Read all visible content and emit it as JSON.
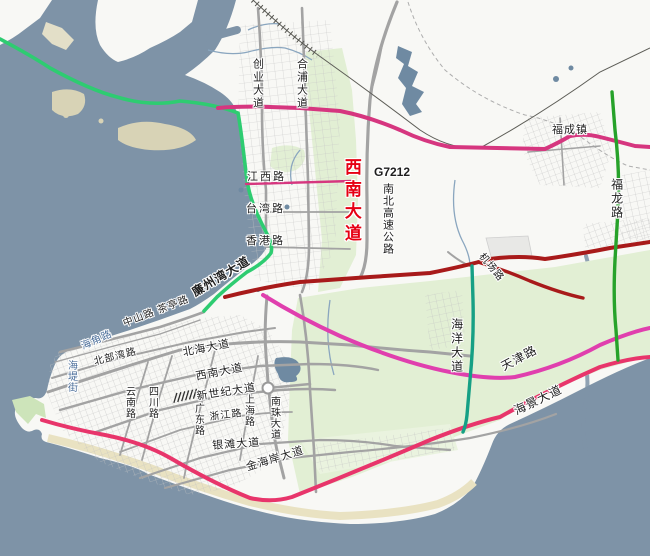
{
  "map": {
    "region": "coastal-city-planning-map",
    "colors": {
      "sea": "#7e93a7",
      "land": "#f8f8f5",
      "vegetation": "#e2efd4",
      "sand_flat": "#d8d3b6",
      "beach": "#e9e2c2",
      "road_gray": "#a3a3a3",
      "road_green": "#2ecc71",
      "road_dark_green": "#27a22a",
      "road_magenta": "#d6367f",
      "road_pink": "#e03fae",
      "road_crimson": "#e8356b",
      "road_dark_red": "#a81a1a",
      "road_teal": "#16a085",
      "label_red": "#e60013",
      "label_blue": "#4c6f9b"
    }
  },
  "labels": [
    {
      "id": "chuangye-dadao",
      "text": "创业大道"
    },
    {
      "id": "hepu-dadao",
      "text": "合浦大道"
    },
    {
      "id": "jiangxi-lu",
      "text": "江西路"
    },
    {
      "id": "taiwan-lu",
      "text": "台湾路"
    },
    {
      "id": "xianggang-lu",
      "text": "香港路"
    },
    {
      "id": "xinan-dadao-red",
      "text": "西南大道"
    },
    {
      "id": "g7212",
      "text": "G7212"
    },
    {
      "id": "nanbei-gaosu",
      "text": "南北高速公路"
    },
    {
      "id": "fucheng-zhen",
      "text": "福成镇"
    },
    {
      "id": "fulong-lu",
      "text": "福龙路"
    },
    {
      "id": "jichang-lu",
      "text": "机场路"
    },
    {
      "id": "haiyang-dadao",
      "text": "海洋大道"
    },
    {
      "id": "tianjin-lu",
      "text": "天津路"
    },
    {
      "id": "haijing-dadao",
      "text": "海景大道"
    },
    {
      "id": "lianzhouwan-dadao",
      "text": "廉州湾大道"
    },
    {
      "id": "zhongshan-chating",
      "text": "中山路 茶亭路"
    },
    {
      "id": "haijiao-lu",
      "text": "海角路"
    },
    {
      "id": "haidi-jie",
      "text": "海堤街"
    },
    {
      "id": "beibuwan-lu",
      "text": "北部湾路"
    },
    {
      "id": "beihai-dadao",
      "text": "北海大道"
    },
    {
      "id": "xinan-dadao",
      "text": "西南大道"
    },
    {
      "id": "yunnan-lu",
      "text": "云南路"
    },
    {
      "id": "sichuan-lu",
      "text": "四川路"
    },
    {
      "id": "xinshiji-dadao",
      "text": "新世纪大道"
    },
    {
      "id": "shanghai-lu",
      "text": "上海路"
    },
    {
      "id": "nanzhu-dadao",
      "text": "南珠大道"
    },
    {
      "id": "guangdong-lu",
      "text": "广东路"
    },
    {
      "id": "zhejiang-lu",
      "text": "浙江路"
    },
    {
      "id": "yintan-dadao",
      "text": "银滩大道"
    },
    {
      "id": "jinhaian-dadao",
      "text": "金海岸大道"
    }
  ]
}
